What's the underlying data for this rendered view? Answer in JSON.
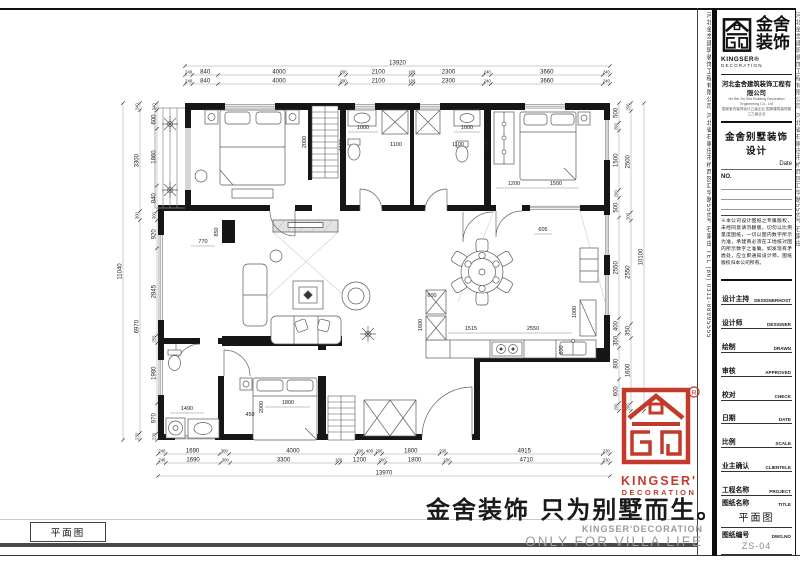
{
  "sheet": {
    "footer_label": "平面图",
    "watermark": {
      "cn": "金舍装饰 只为别墅而生。",
      "en1": "KINGSER'DECORATION",
      "en2": "ONLY FOR VILLA LIFE"
    },
    "side_strip_left": "河北金舍建筑装饰工程有限公司 河北省石家庄市桥西区汇华路556号 石家庄 TEL (86) 0311-88995555",
    "side_strip_right": "河北金舍建筑装饰工程有限公司 河北省石家庄市桥西区汇华路556号 石家庄"
  },
  "red_logo": {
    "line1": "KINGSER'",
    "line2": "DECORATION",
    "registered": "®"
  },
  "title_block": {
    "brand_cn_1": "金舍",
    "brand_cn_2": "装饰",
    "brand_en": "KINGSER®",
    "brand_en_sub": "DECORATION",
    "company": "河北金舍建筑装饰工程有限公司",
    "company_en": "He Bei Jin She Building Decoration Engineering Co., Ltd",
    "company_cert": "国家室内装饰设计乙级企业 国家建筑装饰施工乙级企业",
    "project_title": "金舍别墅装饰设计",
    "date_label": "Date",
    "no_label": "NO.",
    "notes": "※本公司设计图纸之专属版权，未经同意请勿翻版。切勿以比例量度图纸，一切以图内数字所示为准，承建商必须在工地核对图内所示数字之准确，如发现有矛盾处，应立即通知设计师。图纸版权归本公司所有。",
    "fields": [
      {
        "cn": "设计主持",
        "en": "DESIGNERHOST"
      },
      {
        "cn": "设计师",
        "en": "DESIGNER"
      },
      {
        "cn": "绘制",
        "en": "DRAWN"
      },
      {
        "cn": "审核",
        "en": "APPROVED"
      },
      {
        "cn": "校对",
        "en": "CHECK"
      },
      {
        "cn": "日期",
        "en": "DATE"
      },
      {
        "cn": "比例",
        "en": "SCALE"
      },
      {
        "cn": "业主确认",
        "en": "CLIENTELE"
      },
      {
        "cn": "工程名称",
        "en": "PROJECT"
      },
      {
        "cn": "图纸名称",
        "en": "TITLE",
        "value": "平面图"
      },
      {
        "cn": "图纸编号",
        "en": "DWG.NO",
        "value": "ZS-04"
      }
    ]
  },
  "dimensions": {
    "top": {
      "total": "13920",
      "rows": [
        [
          "240",
          "840",
          "4000",
          "200",
          "2100",
          "100",
          "2300",
          "240",
          "3660",
          "240"
        ],
        [
          "240",
          "840",
          "4000",
          "200",
          "2100",
          "100",
          "2300",
          "240",
          "3660",
          "240"
        ]
      ]
    },
    "bottom": {
      "total": "13970",
      "rows": [
        [
          "240",
          "1690",
          "300",
          "4000",
          "200",
          "400",
          "200",
          "1800",
          "200",
          "4915",
          "230"
        ],
        [
          "240",
          "1690",
          "300",
          "3300",
          "100",
          "1200",
          "200",
          "1800",
          "200",
          "4710",
          "230"
        ]
      ]
    },
    "left": {
      "total": "11040",
      "outer": [
        "240",
        "3300",
        "300",
        "6970",
        "230"
      ],
      "inner": [
        "240",
        "600",
        "1860",
        "840",
        "300",
        "920",
        "2845",
        "255",
        "1980",
        "970",
        "230"
      ]
    },
    "right": {
      "total": "10100",
      "inner": [
        "500",
        "200",
        "1500",
        "200",
        "500",
        "2550",
        "400",
        "350",
        "800",
        "600",
        "200"
      ],
      "outer": [
        "200",
        "2500",
        "200",
        "2550",
        "350",
        "1600",
        "200"
      ]
    },
    "interior": [
      "2000",
      "1000",
      "1100",
      "1100",
      "1100",
      "1000",
      "1285",
      "1200",
      "1500",
      "605",
      "770",
      "850",
      "1515",
      "2550",
      "1000",
      "600",
      "1600",
      "600",
      "2000",
      "1800",
      "450",
      "1490",
      "1470"
    ]
  }
}
